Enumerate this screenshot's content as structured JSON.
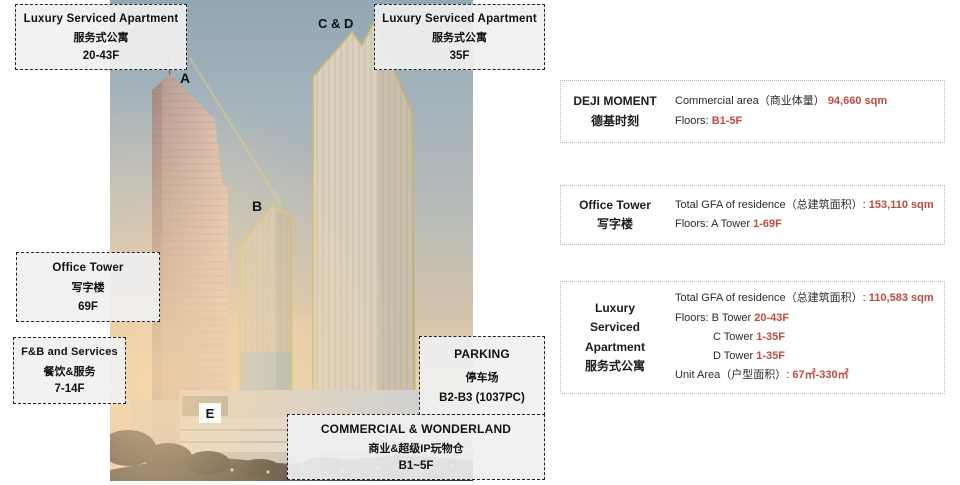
{
  "colors": {
    "accent_red": "#bf4a42",
    "outline_yellow": "#d2c05e"
  },
  "scene": {
    "tower_letters": [
      {
        "id": "a",
        "label": "A"
      },
      {
        "id": "b",
        "label": "B"
      },
      {
        "id": "cd",
        "label": "C & D"
      },
      {
        "id": "e",
        "label": "E"
      }
    ],
    "callouts": [
      {
        "id": "apartment-a",
        "lines": [
          "Luxury Serviced Apartment",
          "服务式公寓",
          "20-43F"
        ]
      },
      {
        "id": "apartment-cd",
        "lines": [
          "Luxury Serviced Apartment",
          "服务式公寓",
          "35F"
        ]
      },
      {
        "id": "office-tower",
        "lines": [
          "Office Tower",
          "写字楼",
          "69F"
        ]
      },
      {
        "id": "fb-services",
        "lines": [
          "F&B and Services",
          "餐饮&服务",
          "7-14F"
        ]
      },
      {
        "id": "parking",
        "lines": [
          "PARKING",
          "停车场",
          "B2-B3 (1037PC)"
        ]
      },
      {
        "id": "commercial",
        "lines": [
          "COMMERCIAL & WONDERLAND",
          "商业&超级IP玩物仓",
          "B1~5F"
        ]
      }
    ]
  },
  "info_panel": {
    "rows": [
      {
        "id": "deji-moment",
        "title_lines": [
          "DEJI MOMENT",
          "德基时刻"
        ],
        "details": [
          {
            "pre": "Commercial area（商业体量） ",
            "value": "94,660 sqm"
          },
          {
            "pre": "Floors: ",
            "value": "B1-5F"
          }
        ]
      },
      {
        "id": "office-tower",
        "title_lines": [
          "Office Tower",
          "写字楼"
        ],
        "details": [
          {
            "pre": "Total GFA of residence（总建筑面积）: ",
            "value": "153,110 sqm"
          },
          {
            "pre": "Floors: A Tower ",
            "value": "1-69F"
          }
        ]
      },
      {
        "id": "luxury-serviced-apartment",
        "title_lines": [
          "Luxury",
          "Serviced",
          "Apartment",
          "服务式公寓"
        ],
        "details": [
          {
            "pre": "Total GFA of residence（总建筑面积）: ",
            "value": "110,583 sqm"
          },
          {
            "pre": "Floors: B Tower ",
            "value": "20-43F"
          },
          {
            "pre": "C Tower ",
            "value": "1-35F"
          },
          {
            "pre": "D Tower ",
            "value": "1-35F"
          },
          {
            "pre": "Unit Area（户型面积）: ",
            "value": "67㎡-330㎡"
          }
        ]
      }
    ]
  }
}
